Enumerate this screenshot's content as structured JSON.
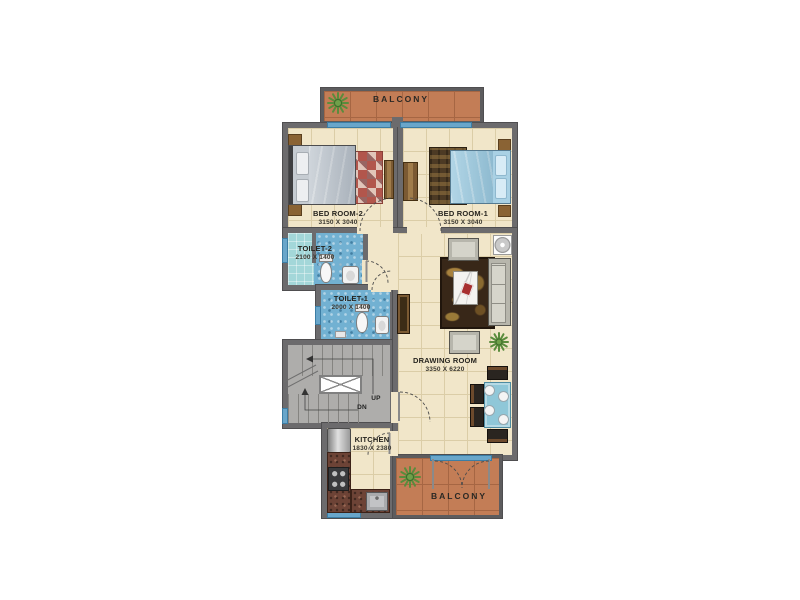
{
  "rooms": {
    "balcony_top": {
      "label": "BALCONY"
    },
    "bedroom2": {
      "label": "BED ROOM-2",
      "dims": "3150 X 3040"
    },
    "bedroom1": {
      "label": "BED ROOM-1",
      "dims": "3150 X 3040"
    },
    "toilet2": {
      "label": "TOILET-2",
      "dims": "2100 X 1400"
    },
    "toilet1": {
      "label": "TOILET-1",
      "dims": "2000 X 1400"
    },
    "drawing_room": {
      "label": "DRAWING ROOM",
      "dims": "3350 X 6220"
    },
    "kitchen": {
      "label": "KITCHEN",
      "dims": "1830 X 2380"
    },
    "balcony_bottom": {
      "label": "BALCONY"
    }
  },
  "stairs": {
    "up": "UP",
    "dn": "DN"
  },
  "colors": {
    "wall": "#6c6b6d",
    "floor_tile": "#f1e6c9",
    "balcony_floor": "#c37d56",
    "toilet_tile": "#72b1d2",
    "window": "#69a6ca",
    "stair_floor": "#aeadab",
    "bed1_blue": "#a9d1e4",
    "bed2_gray": "#c6ccd2",
    "dining_table": "#8fc7d8",
    "counter_brick": "#6d4336",
    "plant_green": "#5a8c3c"
  }
}
